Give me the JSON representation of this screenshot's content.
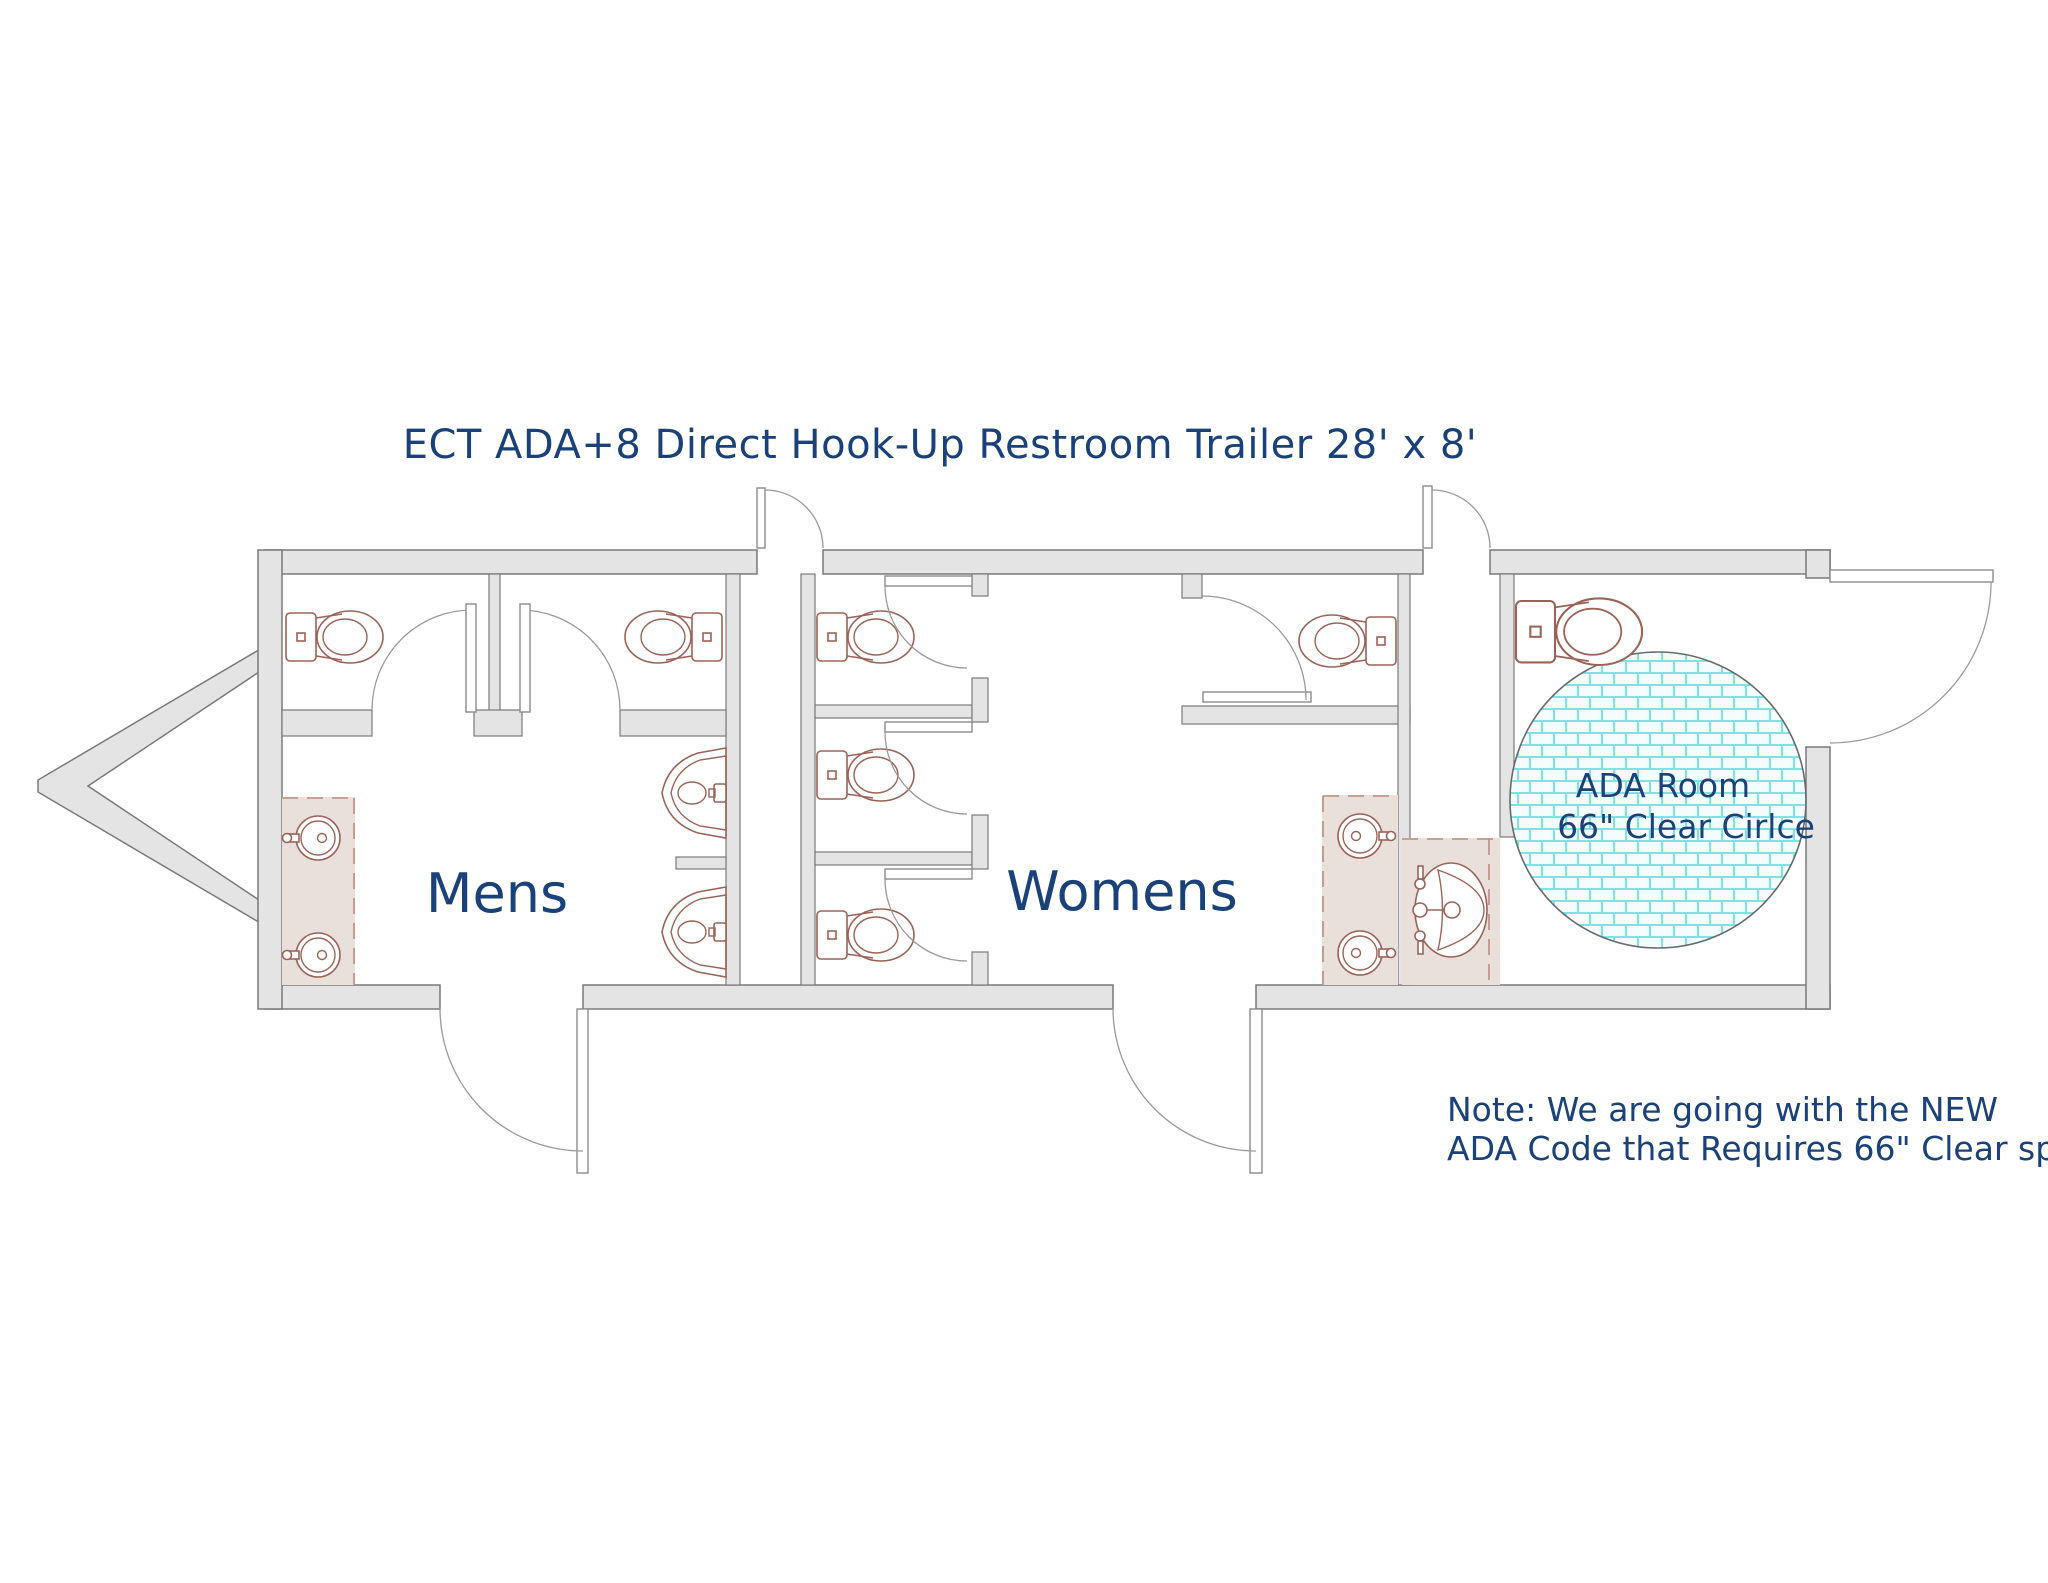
{
  "title": "ECT ADA+8 Direct Hook-Up Restroom Trailer 28' x 8'",
  "rooms": {
    "mens_label": "Mens",
    "womens_label": "Womens"
  },
  "ada_room": {
    "line1": "ADA Room",
    "line2": "66\" Clear Cirlce"
  },
  "note": {
    "line1": "Note: We are going with the NEW",
    "line2": "ADA Code that Requires 66\" Clear space"
  },
  "fixtures": {
    "mens": {
      "toilets": 2,
      "urinals": 2,
      "sinks": 2
    },
    "womens": {
      "toilets": 4,
      "sinks": 2
    },
    "ada": {
      "toilets": 1,
      "sinks": 1
    }
  },
  "colors": {
    "text_navy": "#1b4179",
    "fixture": "#9b6358",
    "wall_fill": "#e4e4e4",
    "wall_stroke": "#7a7a7a",
    "counter_fill": "#eae0db",
    "counter_stroke": "#bb8a7f",
    "tile_mortar": "#7fe3e3",
    "tile_face": "#f4fdfd"
  }
}
